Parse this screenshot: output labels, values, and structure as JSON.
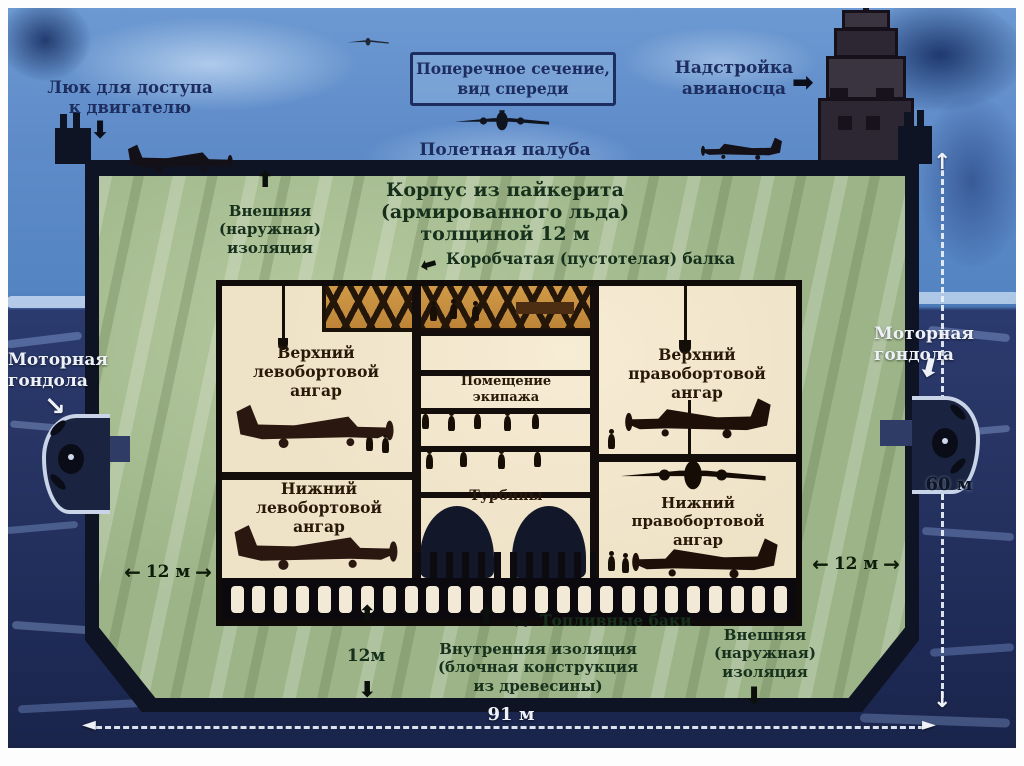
{
  "colors": {
    "sky": "#5f8cc9",
    "ocean": "#232f5c",
    "hull_green": "#9cb488",
    "hull_border": "#0e1424",
    "room_background": "#eee2c7",
    "beam_orange": "#c28a3c",
    "label_navy": "#1d2d60",
    "label_green": "#17301c",
    "label_brown": "#281808",
    "label_white": "#eef2f8"
  },
  "annotations": {
    "section_title": "Поперечное сечение,\nвид спереди",
    "engine_hatch": "Люк для доступа\nк двигателю",
    "superstructure": "Надстройка\nавианосца",
    "flight_deck": "Полетная палуба",
    "hull_material": "Корпус из пайкерита\n(армированного льда)\nтолщиной 12 м",
    "outer_insulation_top": "Внешняя\n(наружная)\nизоляция",
    "box_beam": "Коробчатая (пустотелая) балка",
    "upper_port_hangar": "Верхний\nлевобортовой\nангар",
    "crew_quarters": "Помещение\nэкипажа",
    "upper_starboard_hangar": "Верхний\nправобортовой\nангар",
    "lower_port_hangar": "Нижний\nлевобортовой\nангар",
    "turbines": "Турбины",
    "lower_starboard_hangar": "Нижний правобортовой\nангар",
    "fuel_tanks": "Топливные баки",
    "inner_insulation": "Внутренняя изоляция\n(блочная конструкция\nиз древесины)",
    "outer_insulation_bottom": "Внешняя\n(наружная)\nизоляция",
    "engine_pod_left": "Моторная\nгондола",
    "engine_pod_right": "Моторная\nгондола"
  },
  "dimensions": {
    "hull_side_thickness_left": "12 м",
    "hull_side_thickness_right": "12 м",
    "hull_bottom_thickness": "12м",
    "hull_height": "60 м",
    "hull_width": "91 м"
  },
  "icons": {
    "arrow_up": "⬆",
    "arrow_down": "⬇",
    "arrow_left": "⬅",
    "arrow_right": "➡",
    "arrow_down_right": "↘",
    "arrow_up_thin": "↑",
    "arrow_down_thin": "↓",
    "arrow_head_left": "◄",
    "arrow_head_right": "►"
  },
  "fuel_tank_row": {
    "count": 26
  }
}
